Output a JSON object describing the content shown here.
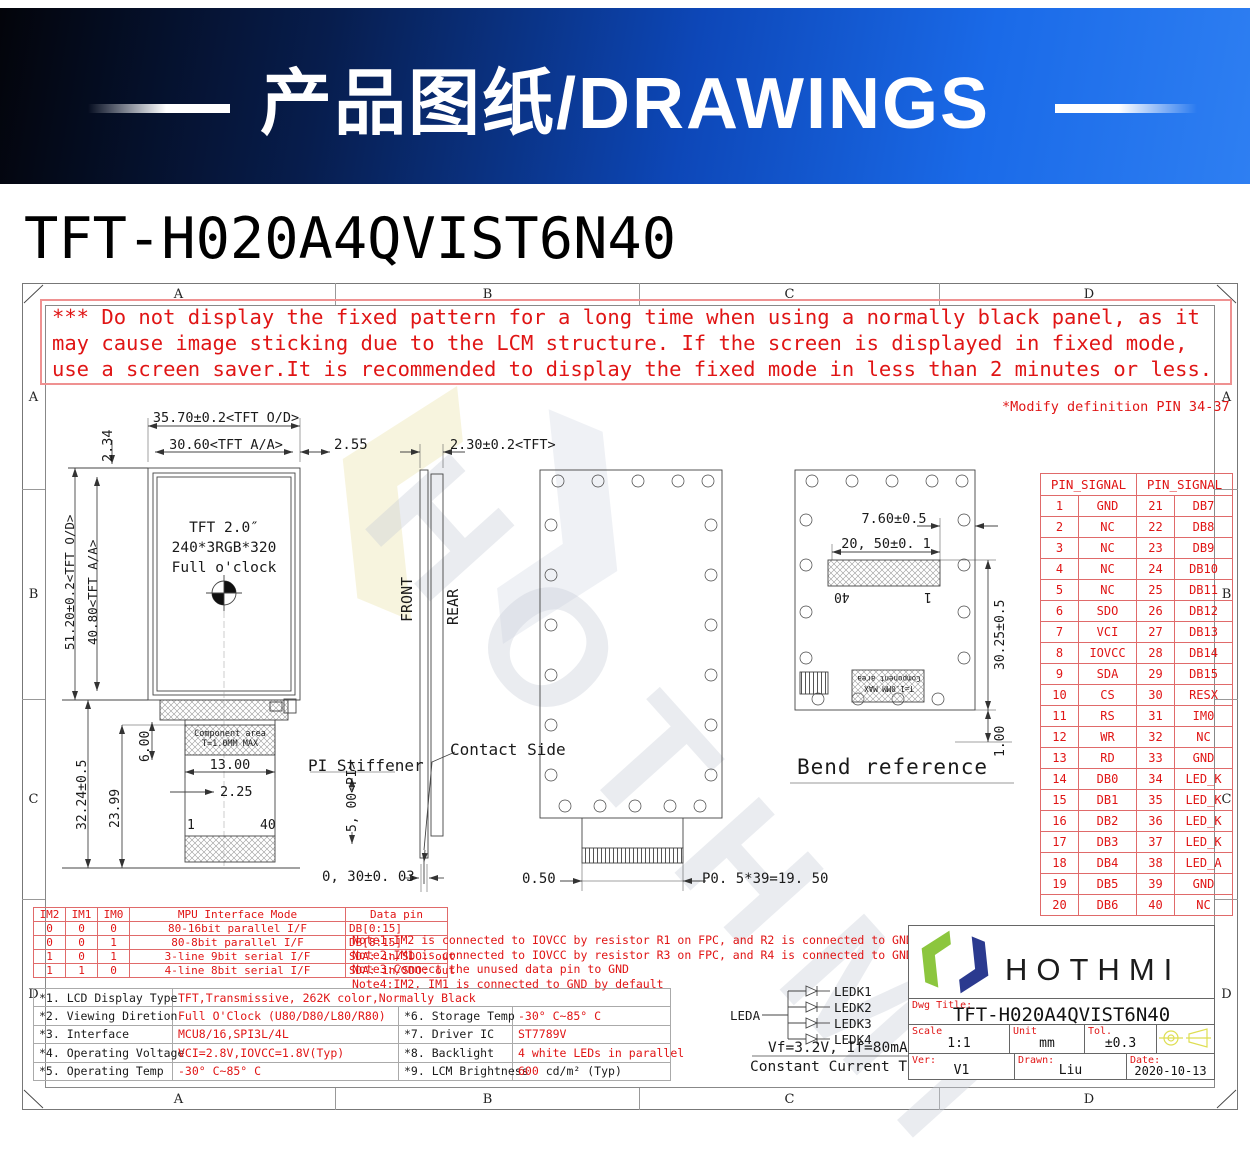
{
  "banner": {
    "title": "产品图纸/DRAWINGS"
  },
  "page_title": "TFT-H020A4QVIST6N40",
  "watermark": {
    "text": "HOTHMI"
  },
  "zones": [
    "A",
    "B",
    "C",
    "D"
  ],
  "warning": {
    "lines": [
      "*** Do not display the fixed pattern for a long time when using a normally black panel, as it",
      "may cause image sticking due to the LCM structure.  If the screen is displayed in fixed mode,",
      "use a screen saver.It is recommended to display the fixed mode in less than 2 minutes or less."
    ]
  },
  "modify_note": "*Modify definition PIN 34-37",
  "dims": {
    "d35_70": "35.70±0.2<TFT O/D>",
    "d30_60": "30.60<TFT A/A>",
    "d2_55": "2.55",
    "d2_30": "2.30±0.2<TFT>",
    "d2_34": "2.34",
    "d51_20": "51.20±0.2<TFT O/D>",
    "d40_80": "40.80<TFT A/A>",
    "d32_24": "32.24±0.5",
    "d23_99": "23.99",
    "d6_00": "6.00",
    "d13_00": "13.00",
    "d2_25": "2.25",
    "d5_00": "5, 00<PI>",
    "d0_30": "0, 30±0. 03",
    "d0_50": "0.50",
    "dp05": "P0. 5*39=19. 50",
    "d7_60": "7.60±0.5",
    "d20_50": "20, 50±0. 1",
    "d30_25": "30.25±0.5",
    "d1_00": "1.00"
  },
  "panel": {
    "lines": [
      "TFT 2.0″",
      "240*3RGB*320",
      "Full o'clock"
    ]
  },
  "labels": {
    "front": "FRONT",
    "rear": "REAR",
    "pi_stiffener": "PI Stiffener",
    "contact_side": "Contact Side",
    "bend_reference": "Bend reference",
    "comp1": "Component area",
    "comp2": "T=1.0MM MAX",
    "pin1": "1",
    "pin40": "40"
  },
  "pin_table": {
    "header": "PIN_SIGNAL",
    "rows": [
      {
        "a": "1",
        "b": "GND",
        "c": "21",
        "d": "DB7"
      },
      {
        "a": "2",
        "b": "NC",
        "c": "22",
        "d": "DB8"
      },
      {
        "a": "3",
        "b": "NC",
        "c": "23",
        "d": "DB9"
      },
      {
        "a": "4",
        "b": "NC",
        "c": "24",
        "d": "DB10"
      },
      {
        "a": "5",
        "b": "NC",
        "c": "25",
        "d": "DB11"
      },
      {
        "a": "6",
        "b": "SDO",
        "c": "26",
        "d": "DB12"
      },
      {
        "a": "7",
        "b": "VCI",
        "c": "27",
        "d": "DB13"
      },
      {
        "a": "8",
        "b": "IOVCC",
        "c": "28",
        "d": "DB14"
      },
      {
        "a": "9",
        "b": "SDA",
        "c": "29",
        "d": "DB15"
      },
      {
        "a": "10",
        "b": "CS",
        "c": "30",
        "d": "RESX"
      },
      {
        "a": "11",
        "b": "RS",
        "c": "31",
        "d": "IM0"
      },
      {
        "a": "12",
        "b": "WR",
        "c": "32",
        "d": "NC"
      },
      {
        "a": "13",
        "b": "RD",
        "c": "33",
        "d": "GND"
      },
      {
        "a": "14",
        "b": "DB0",
        "c": "34",
        "d": "LED_K"
      },
      {
        "a": "15",
        "b": "DB1",
        "c": "35",
        "d": "LED_K"
      },
      {
        "a": "16",
        "b": "DB2",
        "c": "36",
        "d": "LED_K"
      },
      {
        "a": "17",
        "b": "DB3",
        "c": "37",
        "d": "LED_K"
      },
      {
        "a": "18",
        "b": "DB4",
        "c": "38",
        "d": "LED_A"
      },
      {
        "a": "19",
        "b": "DB5",
        "c": "39",
        "d": "GND"
      },
      {
        "a": "20",
        "b": "DB6",
        "c": "40",
        "d": "NC"
      }
    ]
  },
  "itf": {
    "headers": [
      "IM2",
      "IM1",
      "IM0",
      "MPU Interface Mode",
      "Data pin"
    ],
    "rows": [
      {
        "a": "0",
        "b": "0",
        "c": "0",
        "d": "80-16bit parallel I/F",
        "e": "DB[0:15]"
      },
      {
        "a": "0",
        "b": "0",
        "c": "1",
        "d": "80-8bit parallel I/F",
        "e": "DB[8:15]"
      },
      {
        "a": "1",
        "b": "0",
        "c": "1",
        "d": "3-line 9bit serial I/F",
        "e": "SDA: in/SDO: out"
      },
      {
        "a": "1",
        "b": "1",
        "c": "0",
        "d": "4-line 8bit serial I/F",
        "e": "SDA: in/SDO: out"
      }
    ]
  },
  "notes": [
    "Note1:IM2 is connected to IOVCC by resistor R1 on FPC, and R2 is connected to GND",
    "Note2:IM1 is connected to IOVCC by resistor R3 on FPC, and R4 is connected to GND",
    "Note3:Connect the unused data pin to GND",
    "Note4:IM2, IM1 is connected to GND by default"
  ],
  "spec": {
    "rows": [
      {
        "k": "*1. LCD Display Type",
        "v": "TFT,Transmissive, 262K color,Normally Black",
        "k2": "",
        "v2": ""
      },
      {
        "k": "*2. Viewing Diretion",
        "v": "Full O'Clock (U80/D80/L80/R80)",
        "k2": "*6. Storage Temp",
        "v2": "-30° C~85° C"
      },
      {
        "k": "*3. Interface",
        "v": "MCU8/16,SPI3L/4L",
        "k2": "*7. Driver IC",
        "v2": "ST7789V"
      },
      {
        "k": "*4. Operating Voltage",
        "v": "VCI=2.8V,IOVCC=1.8V(Typ)",
        "k2": "*8. Backlight",
        "v2": "4 white LEDs in parallel"
      },
      {
        "k": "*5. Operating Temp",
        "v": "-30° C~85° C",
        "k2": "*9. LCM Brightness",
        "v2": "600",
        "v2b": " cd/m² (Typ)"
      }
    ]
  },
  "led": {
    "leda": "LEDA",
    "k": [
      "LEDK1",
      "LEDK2",
      "LEDK3",
      "LEDK4"
    ],
    "vf": "Vf=3.2V, If=80mA",
    "test": "Constant Current Test"
  },
  "tb": {
    "brand": "HOTHMI",
    "dwg_title_label": "Dwg Title:",
    "dwg_title": "TFT-H020A4QVIST6N40",
    "scale_label": "Scale",
    "scale": "1:1",
    "unit_label": "Unit",
    "unit": "mm",
    "tol_label": "Tol.",
    "tol": "±0.3",
    "ver_label": "Ver:",
    "ver": "V1",
    "drawn_label": "Drawn:",
    "drawn": "Liu",
    "date_label": "Date:",
    "date": "2020-10-13"
  }
}
